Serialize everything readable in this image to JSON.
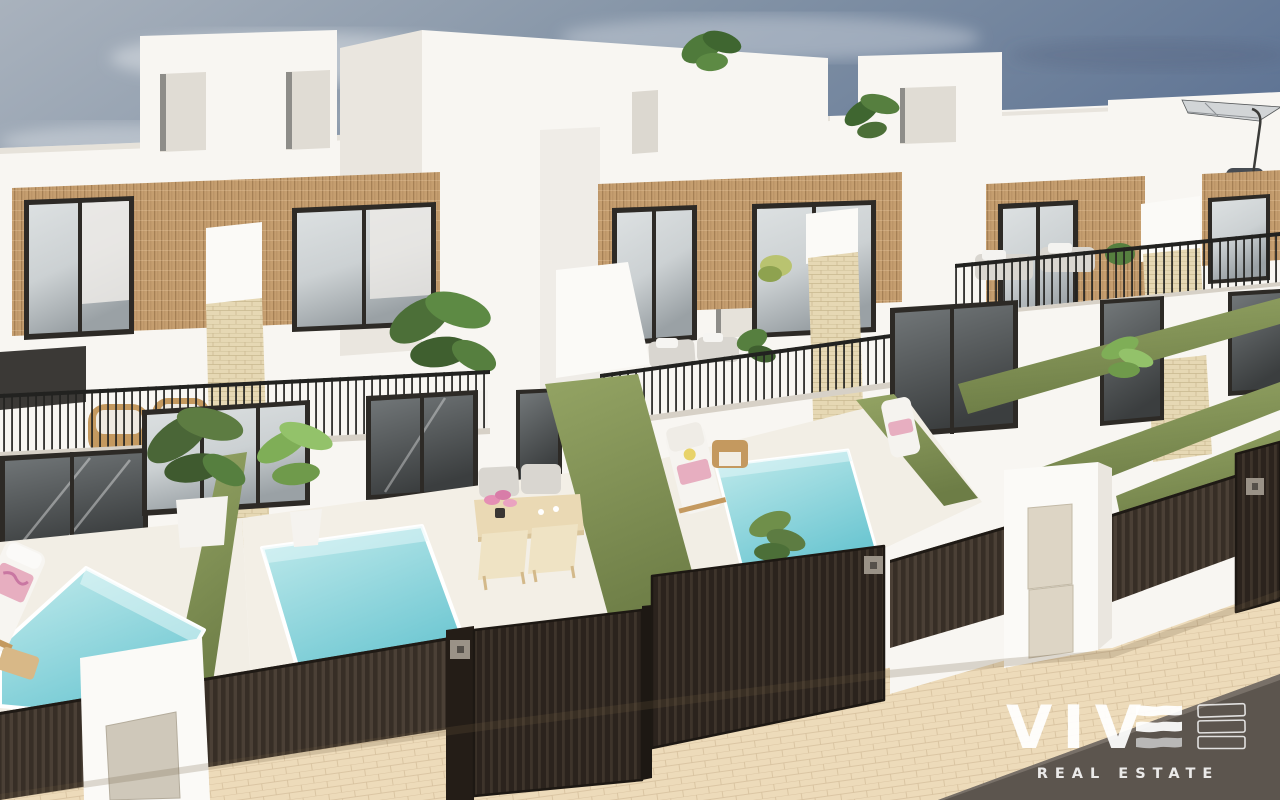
{
  "watermark": {
    "brand": "VIVE",
    "letters": "VIV",
    "tagline": "REAL ESTATE"
  },
  "scene": {
    "description": "3D architectural rendering of a row of modern white two-storey villas with wood-clad upper facades, black framed windows, balcony railings, private turquoise plunge pools, green dividing hedges, dark brown slatted fences and gates, a rooftop parasol, and a sand coloured paved street in the foreground under a hazy blue sky"
  },
  "colors": {
    "sky-deep": "#5f7494",
    "sky-mid": "#8393a6",
    "sky-light": "#a9b2bd",
    "wall": "#f8f6f2",
    "wall-shade": "#eae6df",
    "wall-deep": "#d7d1c7",
    "wood": "#c59e6f",
    "frame": "#2d2a26",
    "glass": "#ccd1d3",
    "rail": "#222220",
    "hedge": "#87975a",
    "hedge-dark": "#6d7d46",
    "pool-hi": "#c2ebec",
    "pool-lo": "#6ec7d2",
    "sand": "#e6d8b4",
    "fence": "#372e26",
    "fence-hi": "#4b4036",
    "gate": "#2b231d",
    "street": "#eddbba",
    "asphalt": "#5c554e",
    "cushion": "#d9d6d0",
    "rattan": "#c4995f",
    "towel": "#e7aec0",
    "logo": "#ffffff"
  }
}
